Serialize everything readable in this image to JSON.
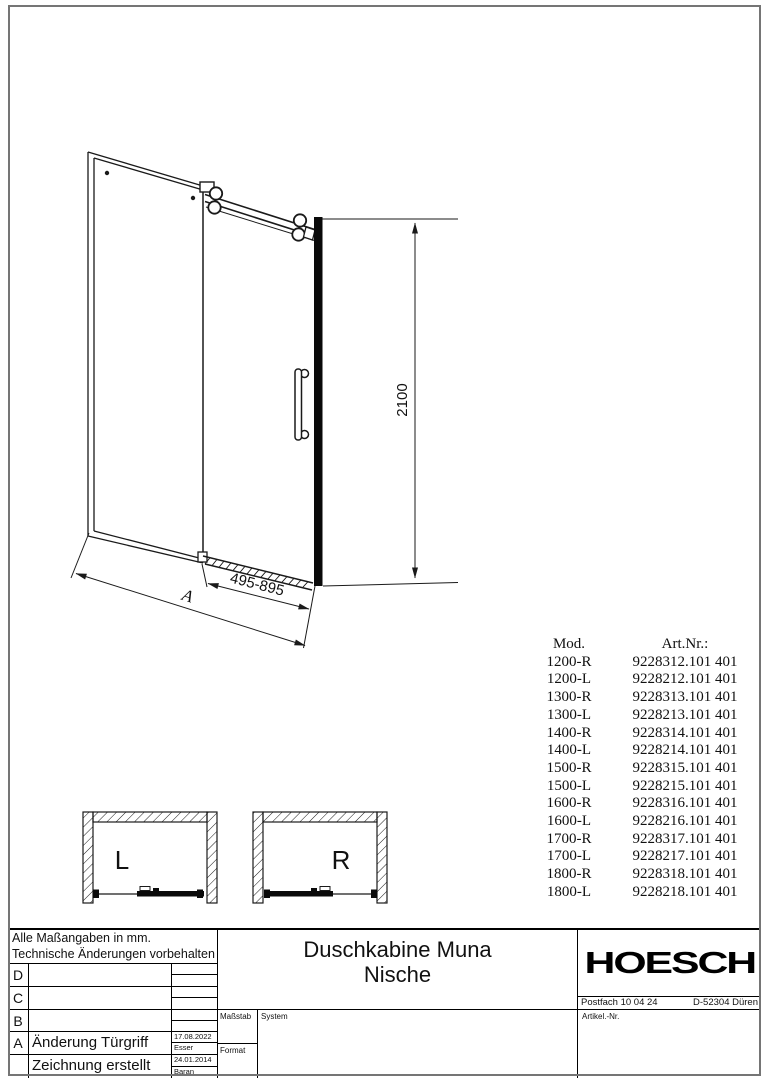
{
  "page": {
    "background": "#ffffff",
    "line_color": "#1a1a1a",
    "frame_color": "#757575"
  },
  "drawing": {
    "height_dim": "2100",
    "door_width_dim": "495-895",
    "total_width_dim": "A"
  },
  "plan_views": {
    "left": "L",
    "right": "R"
  },
  "models": {
    "headers": {
      "mod": "Mod.",
      "art": "Art.Nr.:"
    },
    "rows": [
      {
        "mod": "1200-R",
        "art": "9228312.101 401"
      },
      {
        "mod": "1200-L",
        "art": "9228212.101 401"
      },
      {
        "mod": "1300-R",
        "art": "9228313.101 401"
      },
      {
        "mod": "1300-L",
        "art": "9228213.101 401"
      },
      {
        "mod": "1400-R",
        "art": "9228314.101 401"
      },
      {
        "mod": "1400-L",
        "art": "9228214.101 401"
      },
      {
        "mod": "1500-R",
        "art": "9228315.101 401"
      },
      {
        "mod": "1500-L",
        "art": "9228215.101 401"
      },
      {
        "mod": "1600-R",
        "art": "9228316.101 401"
      },
      {
        "mod": "1600-L",
        "art": "9228216.101 401"
      },
      {
        "mod": "1700-R",
        "art": "9228317.101 401"
      },
      {
        "mod": "1700-L",
        "art": "9228217.101 401"
      },
      {
        "mod": "1800-R",
        "art": "9228318.101 401"
      },
      {
        "mod": "1800-L",
        "art": "9228218.101 401"
      }
    ]
  },
  "title_block": {
    "note_line1": "Alle Maßangaben in mm.",
    "note_line2": "Technische Änderungen vorbehalten",
    "revisions": [
      {
        "letter": "D",
        "desc": "",
        "date": "",
        "name": ""
      },
      {
        "letter": "C",
        "desc": "",
        "date": "",
        "name": ""
      },
      {
        "letter": "B",
        "desc": "",
        "date": "",
        "name": ""
      },
      {
        "letter": "A",
        "desc": "Änderung Türgriff",
        "date": "17.08.2022",
        "name": "Esser"
      },
      {
        "letter": "",
        "desc": "Zeichnung erstellt",
        "date": "24.01.2014",
        "name": "Baran"
      }
    ],
    "title_line1": "Duschkabine Muna",
    "title_line2": "Nische",
    "masstab_label": "Maßstab",
    "system_label": "System",
    "format_label": "Format",
    "brand": "HOESCH",
    "address_po": "Postfach 10 04 24",
    "address_city": "D-52304 Düren",
    "artikel_label": "Artikel.-Nr."
  }
}
